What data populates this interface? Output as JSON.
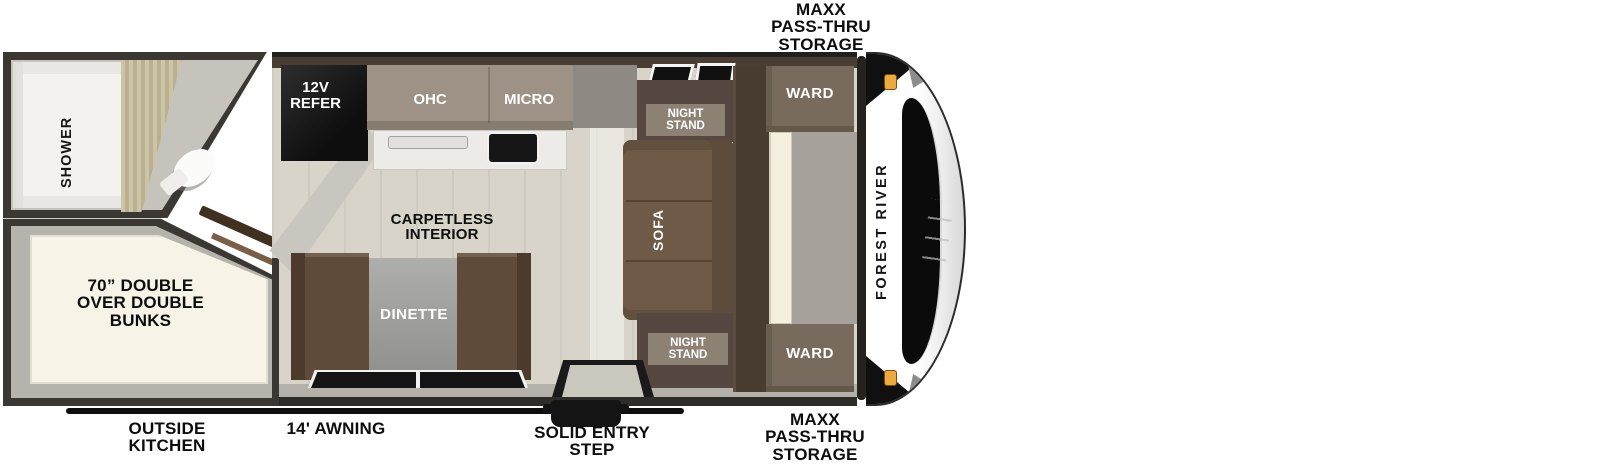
{
  "trailer": {
    "brand_logo": "FOREST RIVER",
    "exterior_labels": {
      "storage_top": "MAXX\nPASS-THRU\nSTORAGE",
      "storage_bottom": "MAXX\nPASS-THRU\nSTORAGE",
      "awning": "14' AWNING",
      "outside_kitchen": "OUTSIDE\nKITCHEN",
      "entry_step": "SOLID ENTRY\nSTEP"
    },
    "interior_labels": {
      "shower": "SHOWER",
      "bunks": "70” DOUBLE\nOVER DOUBLE\nBUNKS",
      "refrigerator": "12V\nREFER",
      "overhead_cabinet": "OHC",
      "microwave": "MICRO",
      "flooring": "CARPETLESS\nINTERIOR",
      "dinette": "DINETTE",
      "sofa": "SOFA",
      "night_stand_top": "NIGHT\nSTAND",
      "night_stand_bottom": "NIGHT\nSTAND",
      "wardrobe_top": "WARD",
      "wardrobe_bottom": "WARD"
    },
    "colors": {
      "wall_dark": "#3a3733",
      "wall_gray": "#b5b2ac",
      "floor_beige": "#d8d4ca",
      "cabinet_taupe": "#9d9285",
      "furniture_brown": "#5f4b39",
      "sofa_brown": "#6f5a47",
      "bunk_cream": "#f7f3e7",
      "marker_light_amber": "#ecaa41"
    }
  }
}
